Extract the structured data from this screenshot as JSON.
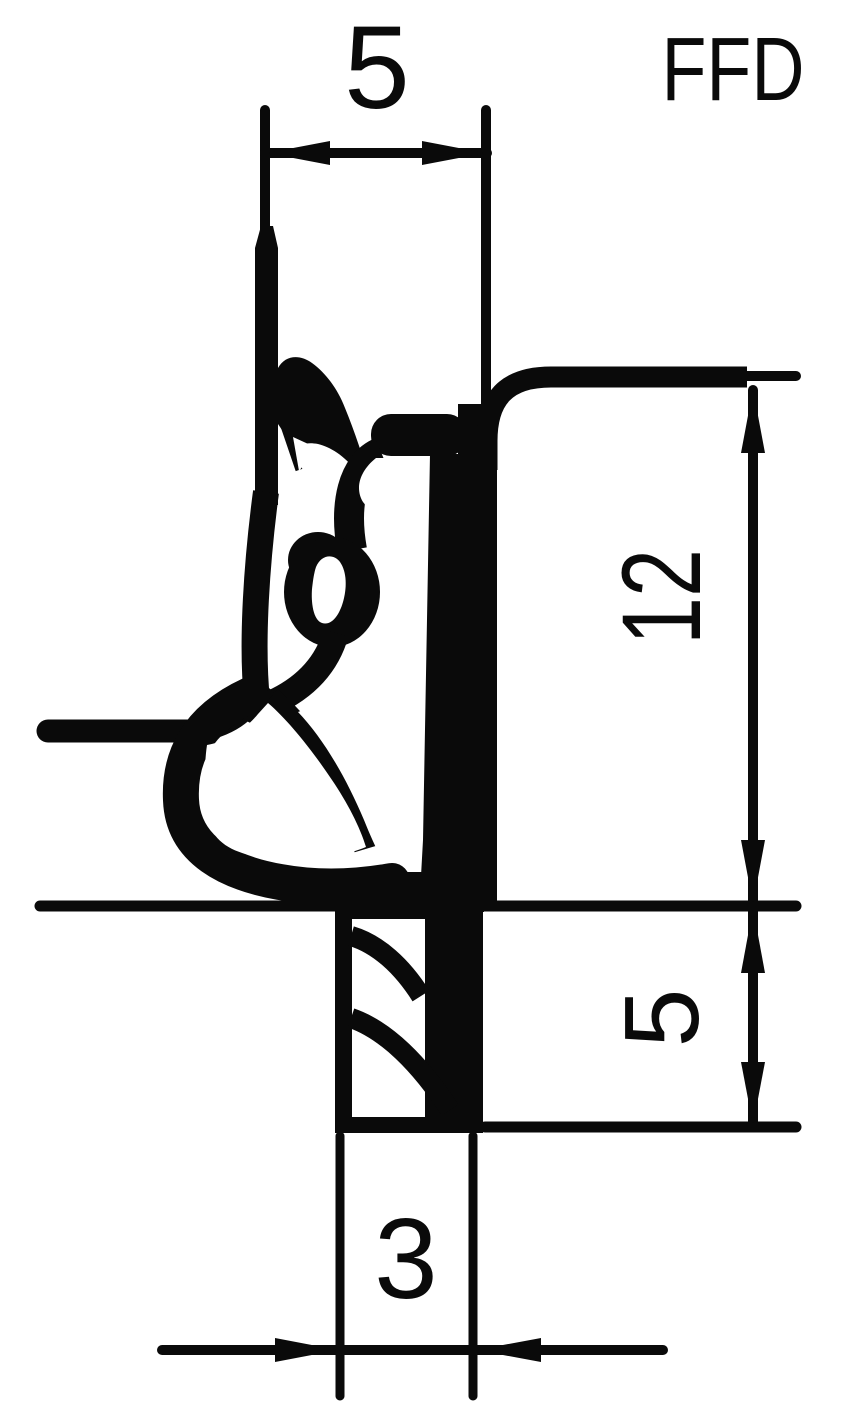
{
  "page": {
    "ink_color": "#0a0a0a",
    "paper_color": "#ffffff"
  },
  "drawing": {
    "product_label": "FFD",
    "type": "seal-profile-cross-section",
    "dimensions": [
      {
        "id": "top-width",
        "value": "5",
        "orientation": "horizontal",
        "position": "top"
      },
      {
        "id": "inner-height",
        "value": "12",
        "orientation": "vertical",
        "position": "right"
      },
      {
        "id": "lower-height",
        "value": "5",
        "orientation": "vertical",
        "position": "right"
      },
      {
        "id": "bottom-width",
        "value": "3",
        "orientation": "horizontal",
        "position": "bottom"
      }
    ]
  }
}
